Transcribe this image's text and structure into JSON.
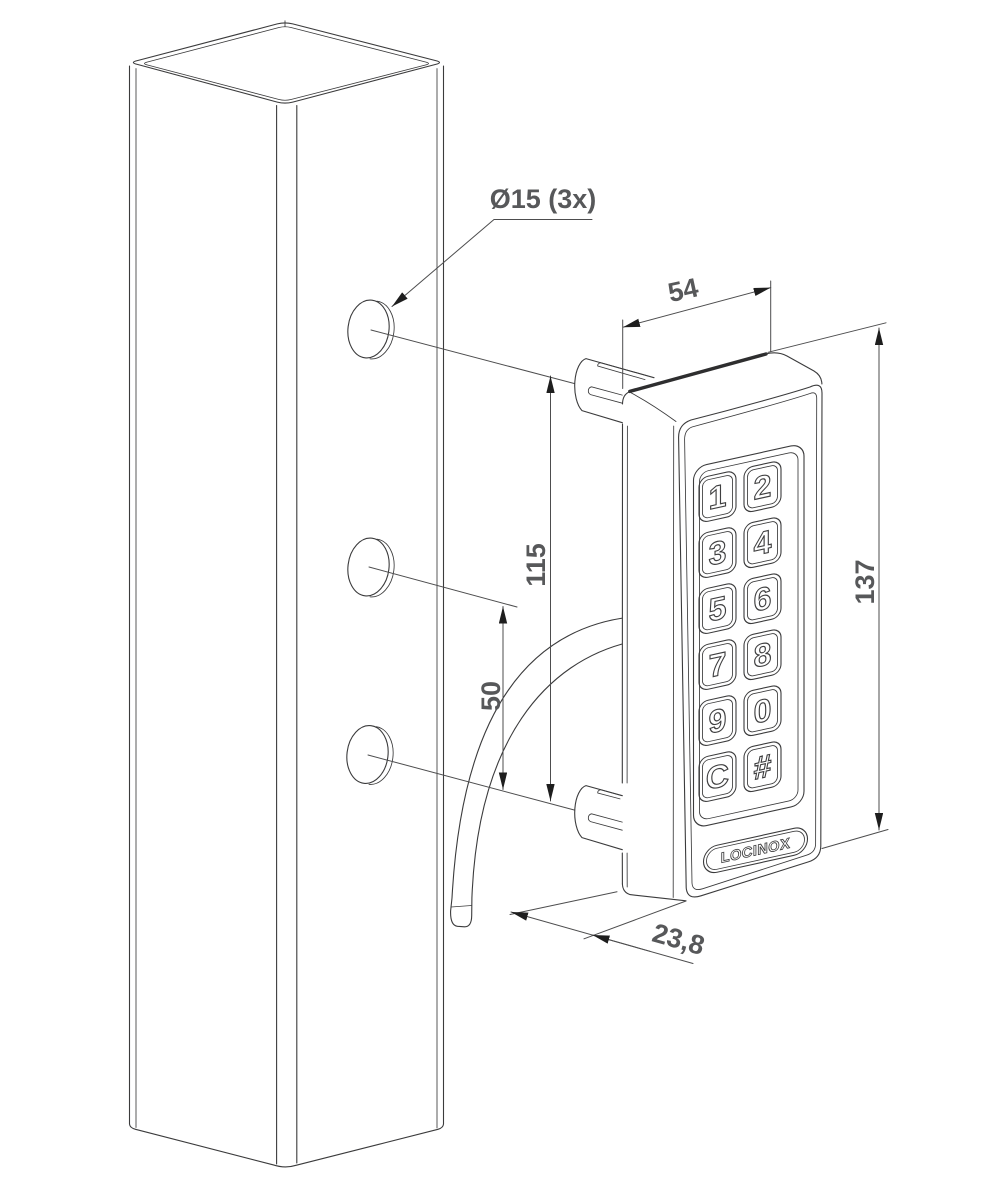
{
  "drawing": {
    "type": "installation-dimension-drawing",
    "brand": "LOCINOX",
    "dims": {
      "hole_label": "Ø15 (3x)",
      "top_width": "54",
      "hole_spacing_outer": "115",
      "hole_spacing_lower": "50",
      "device_height": "137",
      "device_depth": "23,8"
    },
    "keys": [
      "1",
      "2",
      "3",
      "4",
      "5",
      "6",
      "7",
      "8",
      "9",
      "0",
      "C",
      "#"
    ],
    "colors": {
      "line": "#3b3b3c",
      "dim_line": "#4d4d4e",
      "dim_text": "#57585a",
      "arrow": "#1e1e1e",
      "background": "#ffffff"
    }
  }
}
